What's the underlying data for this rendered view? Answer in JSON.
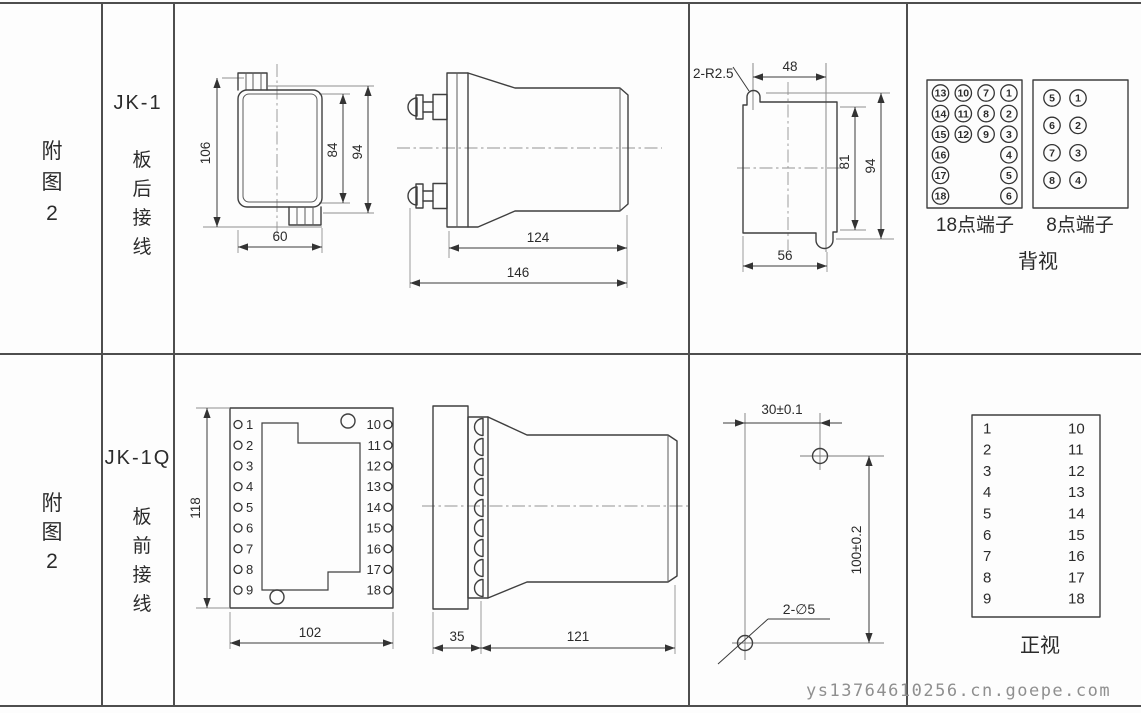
{
  "page": {
    "watermark": "ys13764610256.cn.goepe.com"
  },
  "rows": [
    {
      "figure": [
        "附",
        "图",
        "2"
      ],
      "model": "JK-1",
      "wiring": [
        "板",
        "后",
        "接",
        "线"
      ]
    },
    {
      "figure": [
        "附",
        "图",
        "2"
      ],
      "model": "JK-1Q",
      "wiring": [
        "板",
        "前",
        "接",
        "线"
      ]
    }
  ],
  "jk1": {
    "front_view": {
      "dim_overall_height": "106",
      "dim_case_height": "84",
      "dim_height_with_blocks": "94",
      "dim_width": "60"
    },
    "side_view": {
      "dim_case_length": "124",
      "dim_overall_length": "146"
    },
    "panel_cutout": {
      "corner_radius_note": "2-R2.5",
      "dim_notch_spacing": "48",
      "dim_cutout_height": "81",
      "dim_overall_height": "94",
      "dim_cutout_width": "56"
    },
    "rear_terminals": {
      "block18": {
        "label": "18点端子",
        "rows": [
          [
            13,
            10,
            7,
            1
          ],
          [
            14,
            11,
            8,
            2
          ],
          [
            15,
            12,
            9,
            3
          ],
          [
            16,
            null,
            null,
            4
          ],
          [
            17,
            null,
            null,
            5
          ],
          [
            18,
            null,
            null,
            6
          ]
        ]
      },
      "block8": {
        "label": "8点端子",
        "rows": [
          [
            5,
            1
          ],
          [
            6,
            2
          ],
          [
            7,
            3
          ],
          [
            8,
            4
          ]
        ]
      },
      "view_label": "背视"
    }
  },
  "jk1q": {
    "front_view": {
      "dim_height": "118",
      "dim_width": "102",
      "left_terminals": [
        1,
        2,
        3,
        4,
        5,
        6,
        7,
        8,
        9
      ],
      "right_terminals": [
        10,
        11,
        12,
        13,
        14,
        15,
        16,
        17,
        18
      ]
    },
    "side_view": {
      "dim_panel_depth": "35",
      "dim_case_length": "121"
    },
    "mounting_holes": {
      "dim_horizontal": "30±0.1",
      "dim_vertical": "100±0.2",
      "hole_note": "2-∅5"
    },
    "terminal_map": {
      "left": [
        1,
        2,
        3,
        4,
        5,
        6,
        7,
        8,
        9
      ],
      "right": [
        10,
        11,
        12,
        13,
        14,
        15,
        16,
        17,
        18
      ],
      "view_label": "正视"
    }
  }
}
